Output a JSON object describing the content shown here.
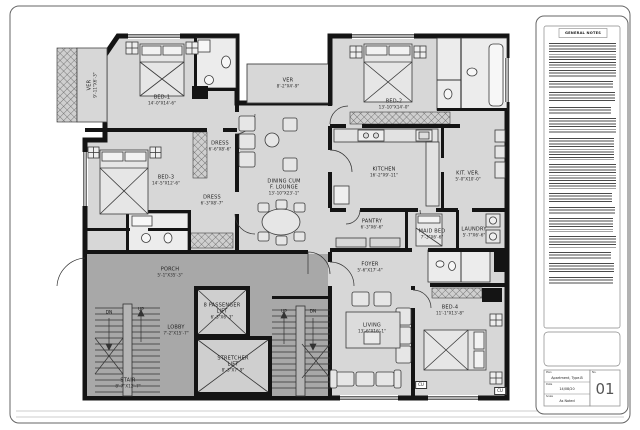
{
  "title_block": {
    "notes_title": "GENERAL NOTES",
    "plan_label": "Plan",
    "plan_value": "Apartment, Type-B",
    "date_label": "Date",
    "date_value": "14/08/20",
    "scale_label": "Scale",
    "scale_value": "As Noted",
    "sheet_label": "No.",
    "sheet_value": "01"
  },
  "plan": {
    "colors": {
      "floor": "#d7d7d7",
      "common_area": "#a8a8a8",
      "wall": "#141414"
    },
    "rooms": [
      {
        "name": "BED-1",
        "dims": "14'-0\"X14'-6\""
      },
      {
        "name": "BED-2",
        "dims": "13'-10\"X14'-0\""
      },
      {
        "name": "BED-3",
        "dims": "14'-5\"X12'-6\""
      },
      {
        "name": "BED-4",
        "dims": "11'-1\"X13'-8\""
      },
      {
        "name": "DRESS",
        "dims": "6'-6\"X8'-6\""
      },
      {
        "name": "DRESS",
        "dims": "6'-3\"X8'-7\""
      },
      {
        "name": "DINING CUM",
        "name2": "F. LOUNGE",
        "dims": "13'-10\"X23'-1\""
      },
      {
        "name": "VER",
        "dims": "9'-11\"X6'-3\""
      },
      {
        "name": "VER",
        "dims": "8'-2\"X4'-9\""
      },
      {
        "name": "KITCHEN",
        "dims": "16'-2\"X9'-11\""
      },
      {
        "name": "KIT. VER.",
        "dims": "5'-0\"X10'-0\""
      },
      {
        "name": "PANTRY",
        "dims": "6'-3\"X6'-6\""
      },
      {
        "name": "MAID BED",
        "dims": "7'-3\"X6'-6\""
      },
      {
        "name": "LAUNDRY",
        "dims": "5'-7\"X6'-6\""
      },
      {
        "name": "FOYER",
        "dims": "5'-6\"X17'-4\""
      },
      {
        "name": "LIVING",
        "dims": "13'-6\"X16'-1\""
      },
      {
        "name": "PORCH",
        "dims": "5'-1\"X35'-3\""
      },
      {
        "name": "LOBBY",
        "dims": "7'-2\"X15'-7\""
      },
      {
        "name": "STAIR",
        "dims": "8'-7\"X12'-7\""
      },
      {
        "name": "8 PASSENGER",
        "name2": "LIFT",
        "dims": "6'-3\"X6'-3\""
      },
      {
        "name": "STRETCHER",
        "name2": "LIFT",
        "dims": "8'-3\"X7'-9\""
      }
    ],
    "markers": {
      "up": "UP",
      "dn": "DN",
      "cu": "CU"
    }
  }
}
